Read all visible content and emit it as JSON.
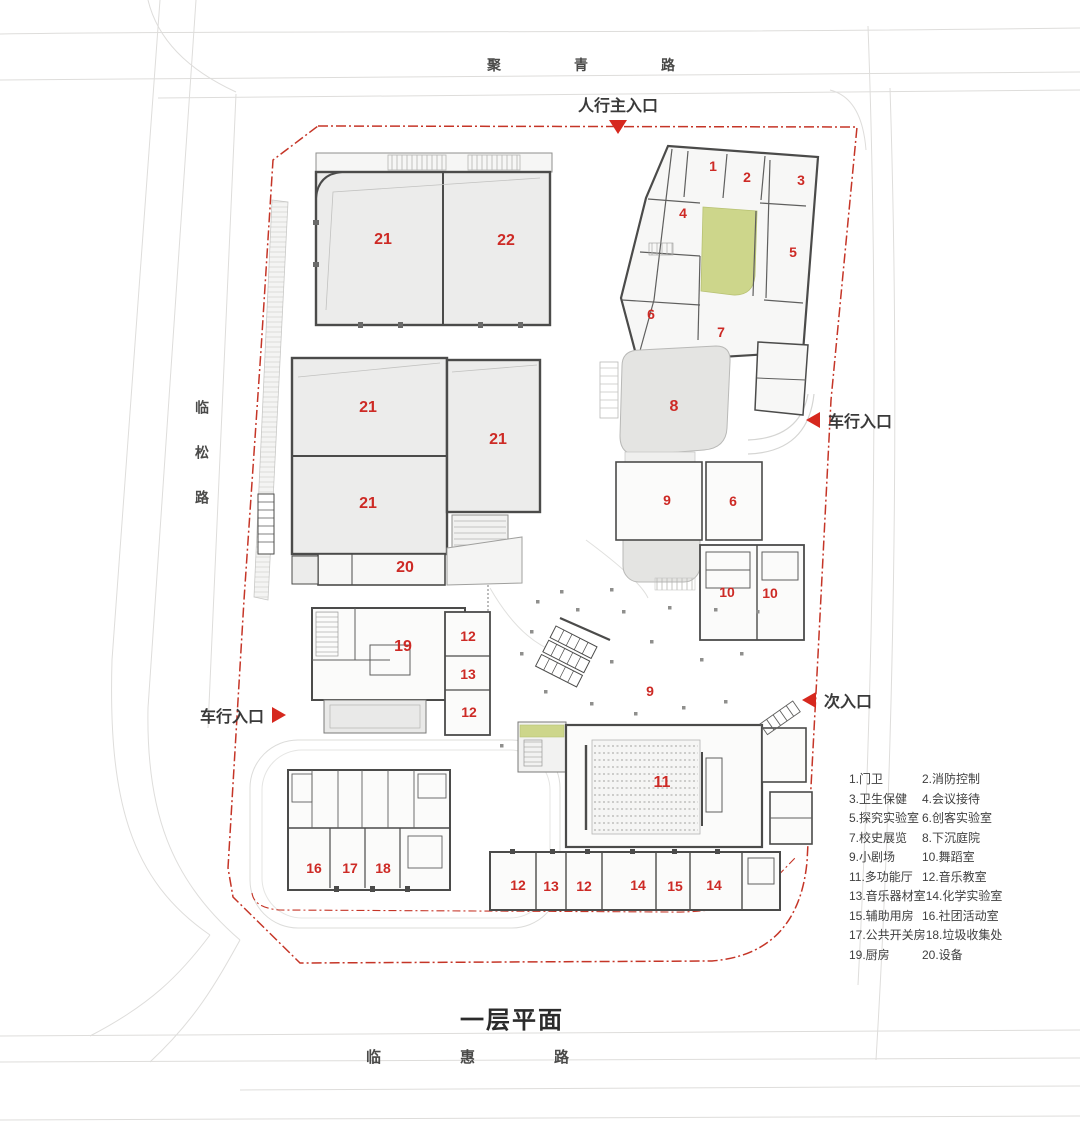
{
  "title": "一层平面",
  "roads": {
    "top": "聚青路",
    "left": "临松路",
    "bottom": "临惠路"
  },
  "entrances": {
    "main": {
      "label": "人行主入口"
    },
    "vehicle_right": {
      "label": "车行入口"
    },
    "secondary": {
      "label": "次入口"
    },
    "vehicle_left": {
      "label": "车行入口"
    }
  },
  "rooms": [
    {
      "n": "21",
      "x": 383,
      "y": 240,
      "big": true
    },
    {
      "n": "22",
      "x": 506,
      "y": 241,
      "big": true
    },
    {
      "n": "1",
      "x": 713,
      "y": 166
    },
    {
      "n": "2",
      "x": 747,
      "y": 177
    },
    {
      "n": "3",
      "x": 801,
      "y": 180
    },
    {
      "n": "4",
      "x": 683,
      "y": 213
    },
    {
      "n": "5",
      "x": 793,
      "y": 252
    },
    {
      "n": "6",
      "x": 651,
      "y": 314
    },
    {
      "n": "7",
      "x": 721,
      "y": 332
    },
    {
      "n": "8",
      "x": 674,
      "y": 407,
      "big": true
    },
    {
      "n": "21",
      "x": 368,
      "y": 408,
      "big": true
    },
    {
      "n": "21",
      "x": 498,
      "y": 440,
      "big": true
    },
    {
      "n": "21",
      "x": 368,
      "y": 504,
      "big": true
    },
    {
      "n": "9",
      "x": 667,
      "y": 500
    },
    {
      "n": "6",
      "x": 733,
      "y": 501
    },
    {
      "n": "20",
      "x": 405,
      "y": 568,
      "big": true
    },
    {
      "n": "10",
      "x": 727,
      "y": 592
    },
    {
      "n": "10",
      "x": 770,
      "y": 593
    },
    {
      "n": "12",
      "x": 468,
      "y": 636
    },
    {
      "n": "19",
      "x": 403,
      "y": 647,
      "big": true
    },
    {
      "n": "13",
      "x": 468,
      "y": 674
    },
    {
      "n": "9",
      "x": 650,
      "y": 691
    },
    {
      "n": "12",
      "x": 469,
      "y": 712
    },
    {
      "n": "11",
      "x": 662,
      "y": 783,
      "big": true
    },
    {
      "n": "16",
      "x": 314,
      "y": 868
    },
    {
      "n": "17",
      "x": 350,
      "y": 868
    },
    {
      "n": "18",
      "x": 383,
      "y": 868
    },
    {
      "n": "12",
      "x": 518,
      "y": 885
    },
    {
      "n": "13",
      "x": 551,
      "y": 886
    },
    {
      "n": "12",
      "x": 584,
      "y": 886
    },
    {
      "n": "14",
      "x": 638,
      "y": 885
    },
    {
      "n": "15",
      "x": 675,
      "y": 886
    },
    {
      "n": "14",
      "x": 714,
      "y": 885
    }
  ],
  "legend": {
    "rows": [
      [
        "1.门卫",
        "2.消防控制"
      ],
      [
        "3.卫生保健",
        "4.会议接待"
      ],
      [
        "5.探究实验室",
        "6.创客实验室"
      ],
      [
        "7.校史展览",
        "8.下沉庭院"
      ],
      [
        "9.小剧场",
        "10.舞蹈室"
      ],
      [
        "11.多功能厅",
        "12.音乐教室"
      ],
      [
        "13.音乐器材室",
        "14.化学实验室"
      ],
      [
        "15.辅助用房",
        "16.社团活动室"
      ],
      [
        "17.公共开关房",
        "18.垃圾收集处"
      ],
      [
        "19.厨房",
        "20.设备"
      ]
    ]
  },
  "colors": {
    "room_number_red": "#cd2a25",
    "entrance_red": "#d6281e",
    "boundary_red": "#c53527",
    "wall_dark": "#4b4b4a",
    "building_fill": "#ececeb",
    "courtyard_green": "#cdd68b",
    "sunken_gray": "#e4e4e2",
    "road_line": "#dedddb"
  }
}
